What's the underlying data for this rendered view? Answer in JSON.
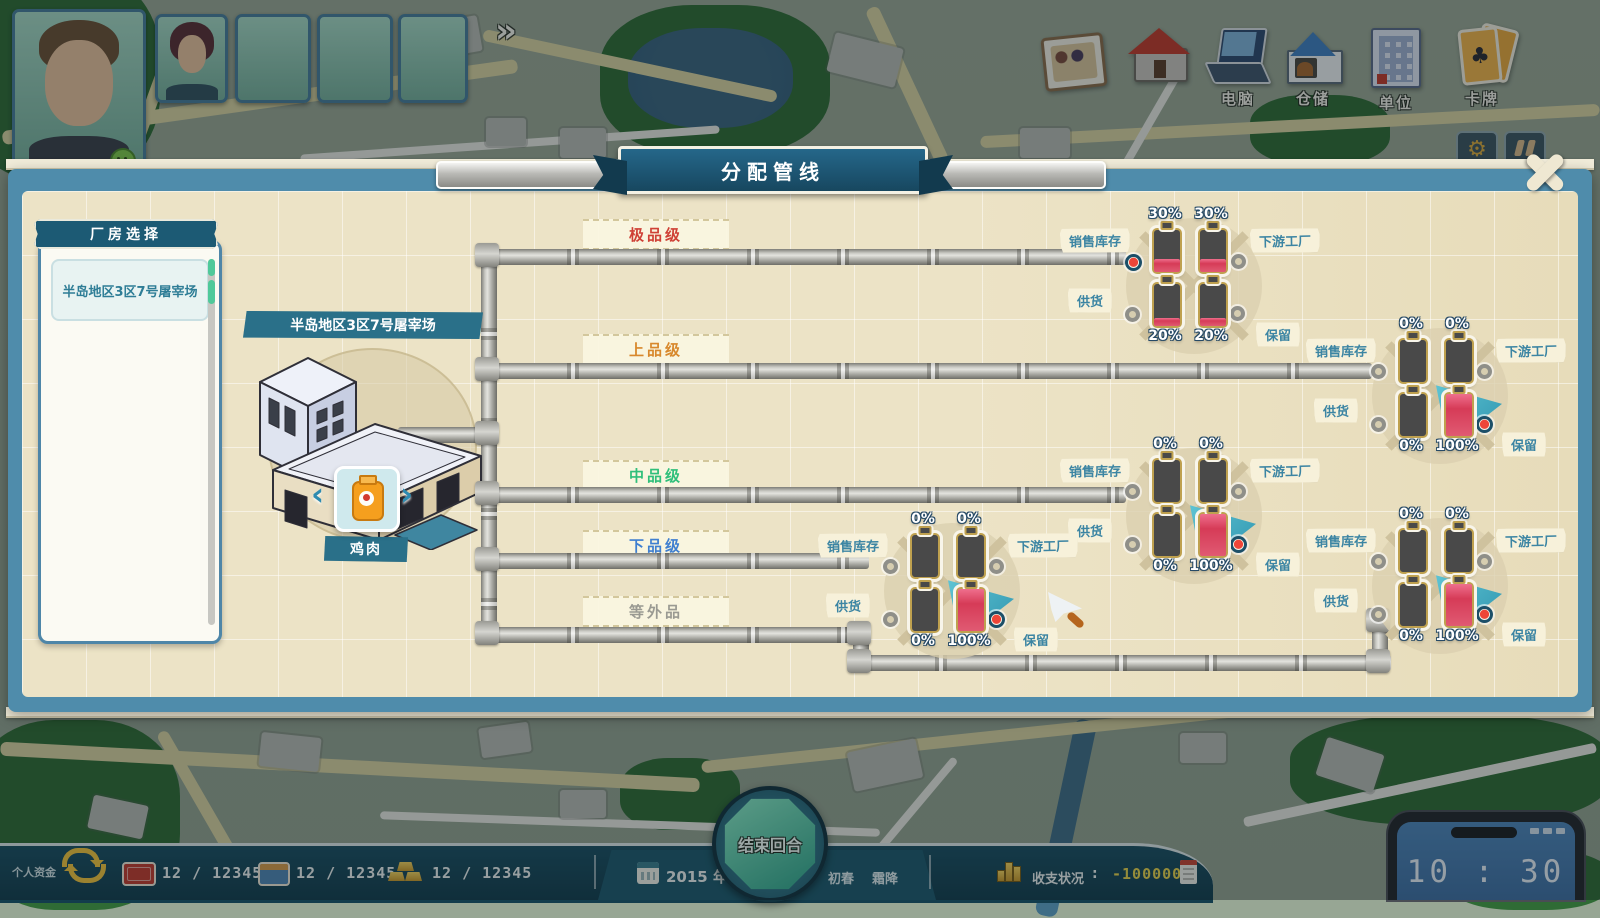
{
  "hud": {
    "party": {
      "expand_button": "»"
    },
    "menu": {
      "items": [
        {
          "label": "电脑"
        },
        {
          "label": "仓储"
        },
        {
          "label": "单位"
        },
        {
          "label": "卡牌"
        }
      ]
    },
    "bottom": {
      "funds_label": "个人资金",
      "resources": [
        {
          "name": "cash",
          "text": "12 / 12345"
        },
        {
          "name": "deposit",
          "text": "12 / 12345"
        },
        {
          "name": "gold",
          "text": "12 / 12345"
        }
      ],
      "year": "2015 年",
      "season": "初春",
      "weather": "霜降",
      "end_turn": "结束回合",
      "balance_label": "收支状况",
      "colon": ":",
      "balance_value": "-100000",
      "phone_time": "10 : 30"
    }
  },
  "panel": {
    "title": "分配管线",
    "sidebar": {
      "header": "厂房选择",
      "items": [
        {
          "label": "半岛地区3区7号屠宰场"
        }
      ]
    },
    "factory": {
      "name": "半岛地区3区7号屠宰场",
      "product": "鸡肉",
      "prev": "‹",
      "next": "›"
    },
    "grades": [
      {
        "label": "极品级",
        "color": "#cf4136"
      },
      {
        "label": "上品级",
        "color": "#d8882c"
      },
      {
        "label": "中品级",
        "color": "#2fbf7a"
      },
      {
        "label": "下品级",
        "color": "#3f7fd0"
      },
      {
        "label": "等外品",
        "color": "#9a9a92"
      }
    ],
    "node_labels": {
      "sales": "销售库存",
      "downstream": "下游工厂",
      "supply": "供货",
      "reserve": "保留"
    },
    "nodes": [
      {
        "sales": "30%",
        "downstream": "30%",
        "supply": "20%",
        "reserve": "20%"
      },
      {
        "sales": "0%",
        "downstream": "0%",
        "supply": "0%",
        "reserve": "100%"
      },
      {
        "sales": "0%",
        "downstream": "0%",
        "supply": "0%",
        "reserve": "100%"
      },
      {
        "sales": "0%",
        "downstream": "0%",
        "supply": "0%",
        "reserve": "100%"
      },
      {
        "sales": "0%",
        "downstream": "0%",
        "supply": "0%",
        "reserve": "100%"
      }
    ],
    "accent_colors": {
      "ribbon_teal": "#1c5a74",
      "battery_gold": "#bfa14f",
      "selected_teal": "#3fb3c9",
      "fill_red": "#d63b57"
    }
  }
}
